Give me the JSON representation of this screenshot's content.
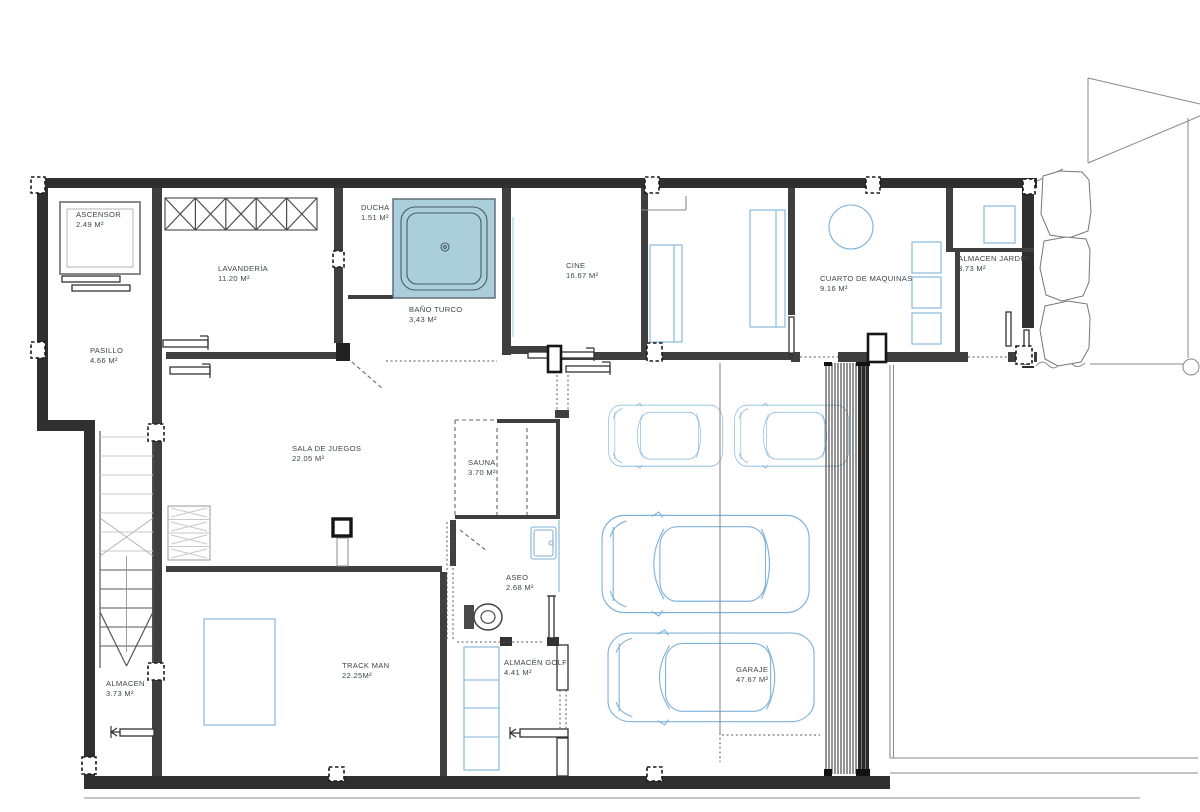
{
  "colors": {
    "accent-blue": "#7fb3d9",
    "shower-fill": "#aacfdb",
    "wall-dark": "#2f2f2f",
    "label-text": "#3f464c"
  },
  "rooms": [
    {
      "id": "ascensor",
      "name": "ASCENSOR",
      "area": "2.49 M²"
    },
    {
      "id": "lavanderia",
      "name": "LAVANDERÍA",
      "area": "11.20 M²"
    },
    {
      "id": "ducha",
      "name": "DUCHA",
      "area": "1.51 M²"
    },
    {
      "id": "bano-turco",
      "name": "BAÑO TURCO",
      "area": "3,43 M²"
    },
    {
      "id": "cine",
      "name": "CINE",
      "area": "16.67 M²"
    },
    {
      "id": "cuarto-de-maquinas",
      "name": "CUARTO DE MAQUINAS",
      "area": "9.16 M²"
    },
    {
      "id": "almacen-jardin",
      "name": "ALMACEN JARDIN",
      "area": "3.73 M²"
    },
    {
      "id": "pasillo",
      "name": "PASILLO",
      "area": "4.66 M²"
    },
    {
      "id": "sala-de-juegos",
      "name": "SALA DE JUEGOS",
      "area": "22.05 M²"
    },
    {
      "id": "sauna",
      "name": "SAUNA",
      "area": "3.70 M²"
    },
    {
      "id": "aseo",
      "name": "ASEO",
      "area": "2.68 M²"
    },
    {
      "id": "track-man",
      "name": "TRACK MAN",
      "area": "22.25M²"
    },
    {
      "id": "almacen-golf",
      "name": "ALMACÉN GOLF",
      "area": "4.41 M²"
    },
    {
      "id": "almacen",
      "name": "ALMACEN",
      "area": "3.73 M²"
    },
    {
      "id": "garaje",
      "name": "GARAJE",
      "area": "47.67 M²"
    }
  ]
}
